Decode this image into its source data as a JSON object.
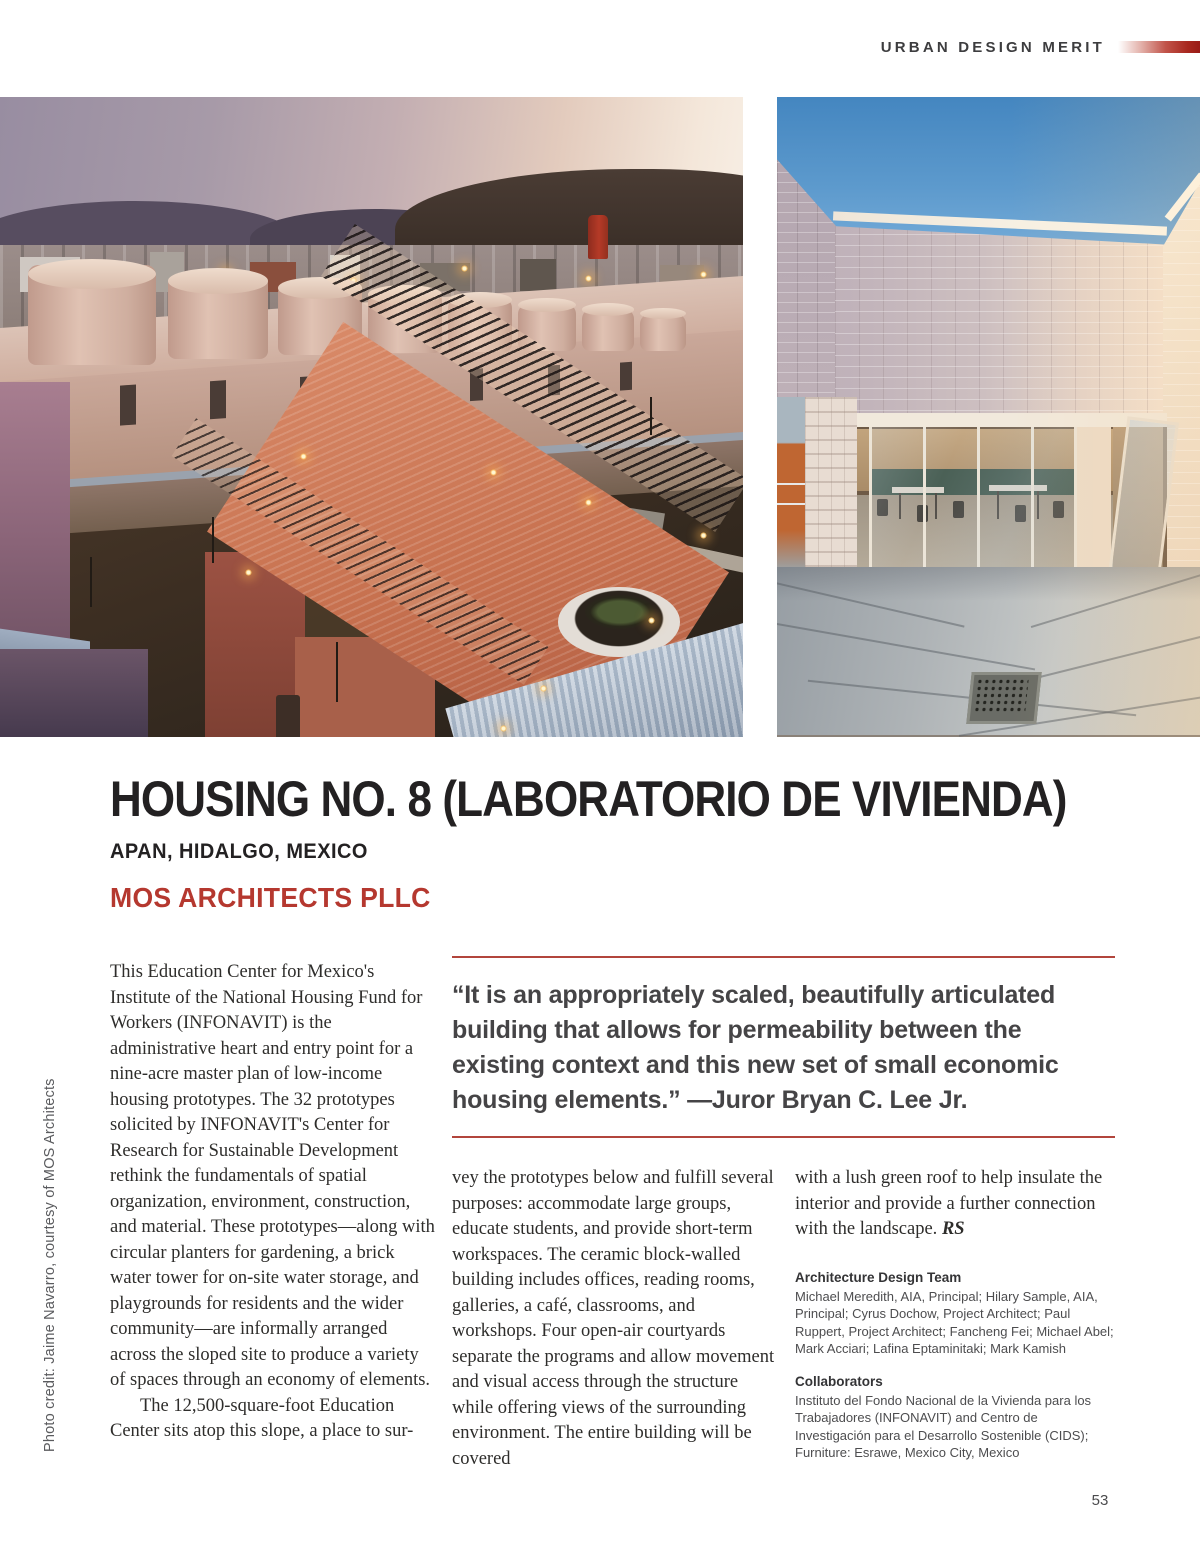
{
  "header": {
    "label": "URBAN DESIGN MERIT"
  },
  "title": {
    "main": "HOUSING NO. 8 (LABORATORIO DE VIVIENDA)",
    "location": "APAN, HIDALGO, MEXICO",
    "firm": "MOS ARCHITECTS PLLC"
  },
  "sidebar": {
    "photo_credit": "Photo credit: Jaime Navarro, courtesy of MOS Architects"
  },
  "photos": {
    "left_alt": "Aerial dusk view of housing development with pink cylindrical water-drum rooftops, red brick gabled building with trellis, blue corrugated roofs and lit pathways",
    "right_alt": "Sunlit courtyard with light block walls, folding glass doors, tables and chairs inside, concrete paving with drain grate"
  },
  "article": {
    "col1_p1": "This Education Center for Mexico's Institute of the National Housing Fund for Workers (INFONAVIT) is the administrative heart and entry point for a nine-acre master plan of low-income housing prototypes. The 32 prototypes solicited by INFONAVIT's Center for Research for Sustainable Development rethink the fundamentals of spatial organization, environment, construction, and material. These prototypes—along with circular planters for gardening, a brick water tower for on-site water storage, and playgrounds for residents and the wider community—are informally arranged across the sloped site to produce a variety of spaces through an economy of elements.",
    "col1_p2": "The 12,500-square-foot Education Center sits atop this slope, a place to sur-",
    "col2": "vey the prototypes below and fulfill several purposes: accommodate large groups, educate students, and provide short-term workspaces. The ceramic block-walled building includes offices, reading rooms, galleries, a café, classrooms, and workshops. Four open-air courtyards separate the programs and allow movement and visual access through the structure while offering views of the surrounding environment. The entire building will be covered",
    "col3": "with a lush green roof to help  insulate the interior and provide a further connection with the landscape. ",
    "col3_sig": "RS"
  },
  "quote": {
    "text": "“It is an appropriately scaled, beautifully articulated building that allows for permeability between the existing context and this new set of small economic housing elements.” —Juror Bryan C. Lee Jr."
  },
  "credits": {
    "team_heading": "Architecture Design Team",
    "team_body": "Michael Meredith, AIA, Principal; Hilary Sample, AIA, Principal; Cyrus Dochow, Project Architect; Paul Ruppert, Project Architect; Fancheng Fei; Michael Abel; Mark Acciari; Lafina Eptaminitaki; Mark Kamish",
    "collab_heading": "Collaborators",
    "collab_body": "Instituto del Fondo Nacional de la Vivienda para los Trabajadores (INFONAVIT) and Centro de Investigación para el Desarrollo Sostenible (CIDS); Furniture: Esrawe, Mexico City, Mexico"
  },
  "footer": {
    "page_number": "53"
  },
  "colors": {
    "accent_red": "#b5382f",
    "rule_red": "#b2453c",
    "bar_red_dark": "#991b17",
    "title_dark": "#232122",
    "body_text": "#2e2d2b",
    "credits_gray": "#4d4d4f"
  }
}
